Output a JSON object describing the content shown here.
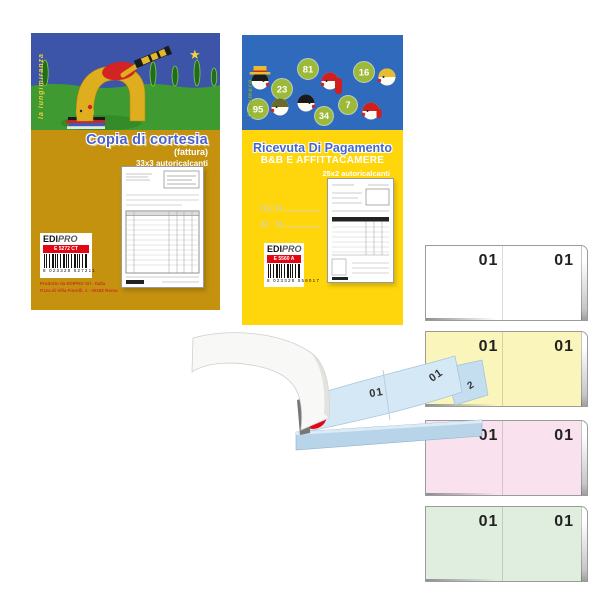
{
  "left_pad": {
    "tagline": "la lungimiranza",
    "title": "Copia di cortesia",
    "subtitle": "(fattura)",
    "spec": "33x3 autoricalcanti",
    "brand_bold": "EDI",
    "brand_light": "PRO",
    "product_code": "E 5272 CT",
    "barcode_digits": "8 023328 527211",
    "footer_line1": "Prodotto da EDIPRO Srl - Italia",
    "footer_line2": "P.zza di Villa Fiorelli, 1 - 00182 Roma",
    "colors": {
      "cover": "#c4920e",
      "sky": "#3c55a9",
      "grass": "#3f9a31",
      "title": "#4a63c8"
    }
  },
  "right_pad": {
    "tagline": "il numero",
    "title": "Ricevuta Di Pagamento",
    "subtitle": "B&B E AFFITTACAMERE",
    "spec": "25x2 autoricalcanti",
    "from_label": "Dal N.",
    "to_label": "Al   N.",
    "bubbles": [
      "23",
      "81",
      "16",
      "95",
      "34",
      "7"
    ],
    "brand_bold": "EDI",
    "brand_light": "PRO",
    "product_code": "E 5560 A",
    "barcode_digits": "8 023328 556017",
    "colors": {
      "cover": "#ffd60b",
      "sky": "#2f6abc",
      "bubble": "#9cb93a",
      "title": "#4468cc"
    }
  },
  "fan_book": {
    "left_number": "01",
    "right_number": "01",
    "under_number": "2",
    "color": "#d5e8f6"
  },
  "blocks": [
    {
      "name": "white",
      "bg": "#ffffff",
      "left_number": "01",
      "right_number": "01"
    },
    {
      "name": "yellow",
      "bg": "#faf5bb",
      "left_number": "01",
      "right_number": "01"
    },
    {
      "name": "pink",
      "bg": "#f9e2ee",
      "left_number": "01",
      "right_number": "01"
    },
    {
      "name": "green",
      "bg": "#dfeede",
      "left_number": "01",
      "right_number": "01"
    }
  ]
}
